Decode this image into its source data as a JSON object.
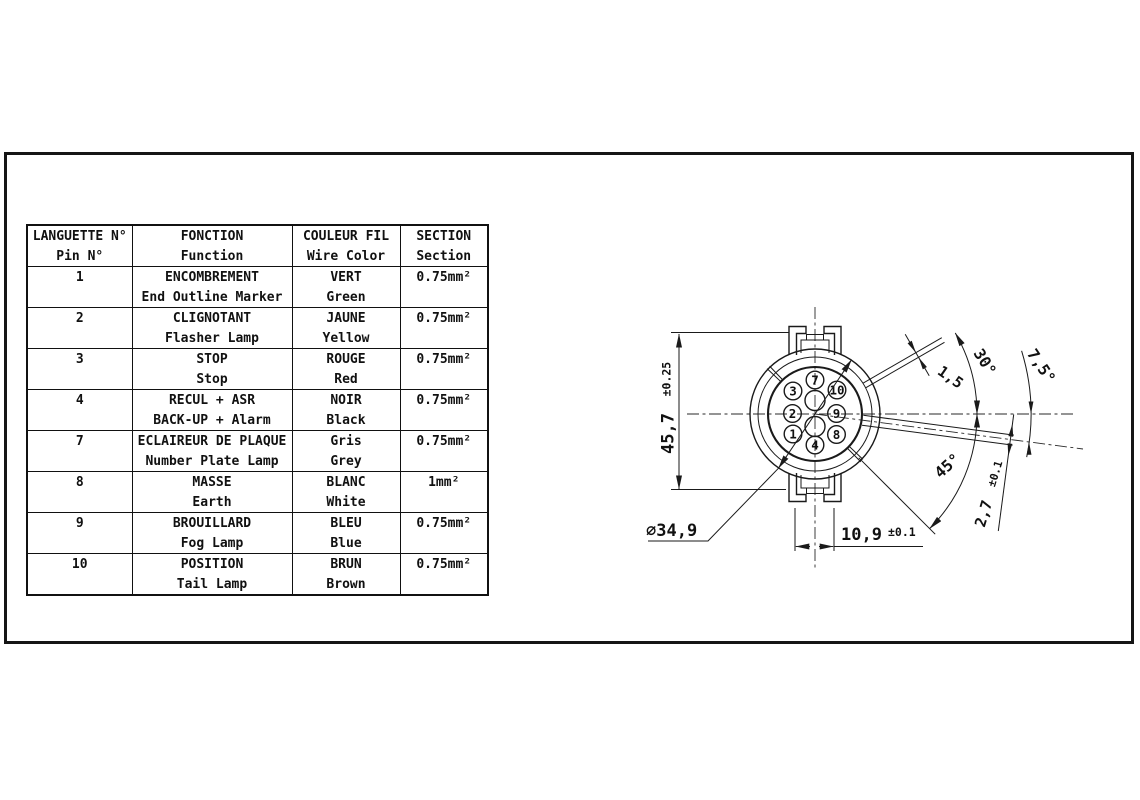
{
  "table": {
    "headers": [
      {
        "fr": "LANGUETTE N°",
        "en": "Pin N°"
      },
      {
        "fr": "FONCTION",
        "en": "Function"
      },
      {
        "fr": "COULEUR FIL",
        "en": "Wire Color"
      },
      {
        "fr": "SECTION",
        "en": "Section"
      }
    ],
    "rows": [
      {
        "pin": "1",
        "fr": "ENCOMBREMENT",
        "en": "End Outline Marker",
        "wire_fr": "VERT",
        "wire_en": "Green",
        "section": "0.75mm²"
      },
      {
        "pin": "2",
        "fr": "CLIGNOTANT",
        "en": "Flasher Lamp",
        "wire_fr": "JAUNE",
        "wire_en": "Yellow",
        "section": "0.75mm²"
      },
      {
        "pin": "3",
        "fr": "STOP",
        "en": "Stop",
        "wire_fr": "ROUGE",
        "wire_en": "Red",
        "section": "0.75mm²"
      },
      {
        "pin": "4",
        "fr": "RECUL + ASR",
        "en": "BACK-UP + Alarm",
        "wire_fr": "NOIR",
        "wire_en": "Black",
        "section": "0.75mm²"
      },
      {
        "pin": "7",
        "fr": "ECLAIREUR DE PLAQUE",
        "en": "Number Plate Lamp",
        "wire_fr": "Gris",
        "wire_en": "Grey",
        "section": "0.75mm²"
      },
      {
        "pin": "8",
        "fr": "MASSE",
        "en": "Earth",
        "wire_fr": "BLANC",
        "wire_en": "White",
        "section": "1mm²"
      },
      {
        "pin": "9",
        "fr": "BROUILLARD",
        "en": "Fog Lamp",
        "wire_fr": "BLEU",
        "wire_en": "Blue",
        "section": "0.75mm²"
      },
      {
        "pin": "10",
        "fr": "POSITION",
        "en": "Tail Lamp",
        "wire_fr": "BRUN",
        "wire_en": "Brown",
        "section": "0.75mm²"
      }
    ]
  },
  "diagram": {
    "pins": [
      "7",
      "3",
      "10",
      "2",
      "9",
      "1",
      "8",
      "4"
    ],
    "dims": {
      "height": {
        "value": "45,7",
        "tol": "±0.25"
      },
      "diameter": "∅34,9",
      "tab_width": {
        "value": "10,9",
        "tol": "±0.1"
      },
      "slot_top": "1,5",
      "angle_top": "30°",
      "angle_right": "7,5°",
      "angle_bottom": "45°",
      "slot_right": {
        "value": "2,7",
        "tol": "±0.1"
      }
    },
    "colors": {
      "line": "#1a1a1a",
      "background": "#ffffff"
    }
  }
}
